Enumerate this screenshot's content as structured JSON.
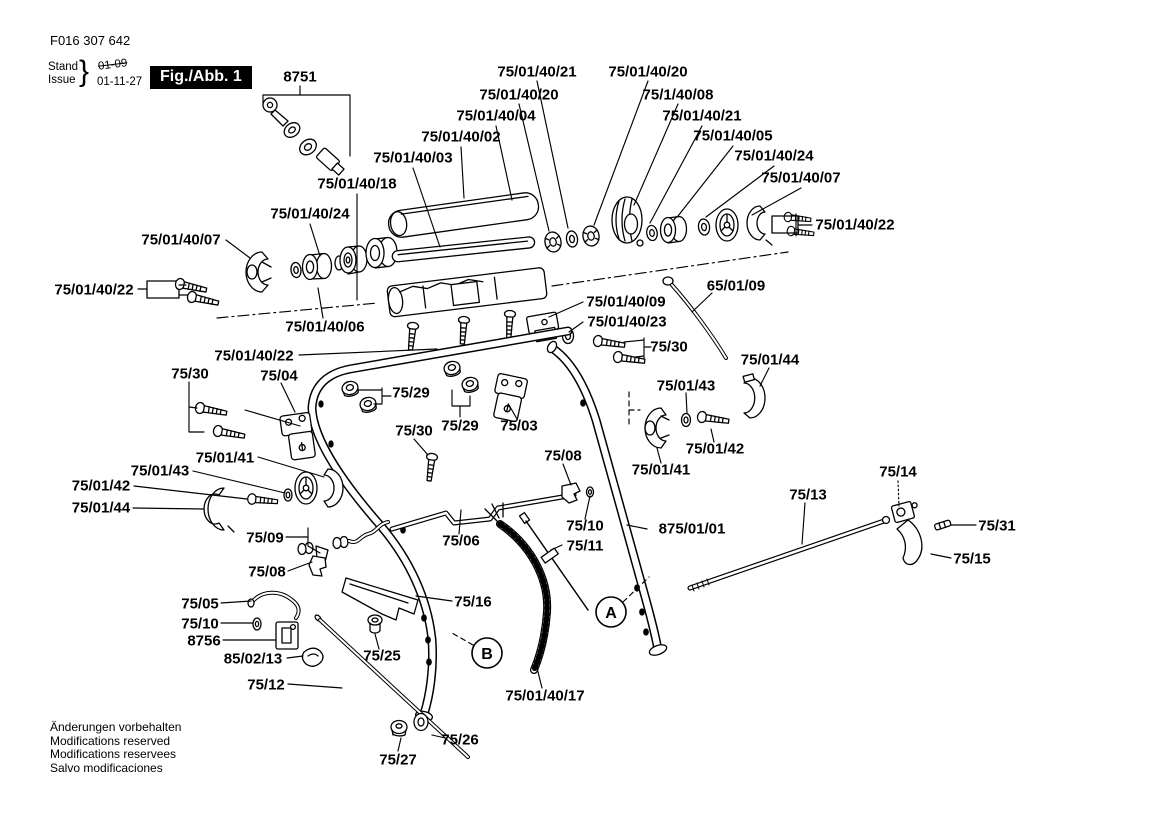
{
  "meta": {
    "part_number": "F016 307 642",
    "stand_label": "Stand",
    "issue_label": "Issue",
    "brace": "}",
    "issue_superseded": "01-09",
    "issue_current": "01-11-27",
    "figure_label": "Fig./Abb. 1"
  },
  "footer": {
    "lines": [
      "Änderungen vorbehalten",
      "Modifications reserved",
      "Modifications reservees",
      "Salvo modificaciones"
    ]
  },
  "colors": {
    "ink": "#000000",
    "paper": "#ffffff",
    "badge_bg": "#000000",
    "badge_fg": "#ffffff"
  },
  "view_markers": [
    {
      "text": "A",
      "x": 611,
      "y": 612
    },
    {
      "text": "B",
      "x": 487,
      "y": 653
    }
  ],
  "labels": [
    {
      "text": "8751",
      "x": 300,
      "y": 77
    },
    {
      "text": "75/01/40/21",
      "x": 537,
      "y": 72
    },
    {
      "text": "75/01/40/20",
      "x": 648,
      "y": 72
    },
    {
      "text": "75/01/40/20",
      "x": 519,
      "y": 95
    },
    {
      "text": "75/1/40/08",
      "x": 678,
      "y": 95
    },
    {
      "text": "75/01/40/04",
      "x": 496,
      "y": 116
    },
    {
      "text": "75/01/40/21",
      "x": 702,
      "y": 116
    },
    {
      "text": "75/01/40/02",
      "x": 461,
      "y": 137
    },
    {
      "text": "75/01/40/05",
      "x": 733,
      "y": 136
    },
    {
      "text": "75/01/40/03",
      "x": 413,
      "y": 158
    },
    {
      "text": "75/01/40/24",
      "x": 774,
      "y": 156
    },
    {
      "text": "75/01/40/18",
      "x": 357,
      "y": 184
    },
    {
      "text": "75/01/40/07",
      "x": 801,
      "y": 178
    },
    {
      "text": "75/01/40/24",
      "x": 310,
      "y": 214
    },
    {
      "text": "75/01/40/07",
      "x": 181,
      "y": 240
    },
    {
      "text": "75/01/40/22",
      "x": 855,
      "y": 225
    },
    {
      "text": "75/01/40/22",
      "x": 94,
      "y": 290
    },
    {
      "text": "75/01/40/06",
      "x": 325,
      "y": 327
    },
    {
      "text": "65/01/09",
      "x": 736,
      "y": 286
    },
    {
      "text": "75/01/40/09",
      "x": 626,
      "y": 302
    },
    {
      "text": "75/01/40/23",
      "x": 627,
      "y": 322
    },
    {
      "text": "75/30",
      "x": 669,
      "y": 347
    },
    {
      "text": "75/01/44",
      "x": 770,
      "y": 360
    },
    {
      "text": "75/01/43",
      "x": 686,
      "y": 386
    },
    {
      "text": "75/01/40/22",
      "x": 254,
      "y": 356
    },
    {
      "text": "75/30",
      "x": 190,
      "y": 374
    },
    {
      "text": "75/04",
      "x": 279,
      "y": 376
    },
    {
      "text": "75/29",
      "x": 411,
      "y": 393
    },
    {
      "text": "75/30",
      "x": 414,
      "y": 431
    },
    {
      "text": "75/29",
      "x": 460,
      "y": 426
    },
    {
      "text": "75/03",
      "x": 519,
      "y": 426
    },
    {
      "text": "75/08",
      "x": 563,
      "y": 456
    },
    {
      "text": "75/01/41",
      "x": 661,
      "y": 470
    },
    {
      "text": "75/01/42",
      "x": 715,
      "y": 449
    },
    {
      "text": "75/01/44",
      "x": 101,
      "y": 508
    },
    {
      "text": "75/01/42",
      "x": 101,
      "y": 486
    },
    {
      "text": "75/01/43",
      "x": 160,
      "y": 471
    },
    {
      "text": "75/01/41",
      "x": 225,
      "y": 458
    },
    {
      "text": "75/09",
      "x": 265,
      "y": 538
    },
    {
      "text": "75/08",
      "x": 267,
      "y": 572
    },
    {
      "text": "75/05",
      "x": 200,
      "y": 604
    },
    {
      "text": "75/10",
      "x": 200,
      "y": 624
    },
    {
      "text": "8756",
      "x": 204,
      "y": 641
    },
    {
      "text": "85/02/13",
      "x": 253,
      "y": 659
    },
    {
      "text": "75/12",
      "x": 266,
      "y": 685
    },
    {
      "text": "75/25",
      "x": 382,
      "y": 656
    },
    {
      "text": "75/16",
      "x": 473,
      "y": 602
    },
    {
      "text": "75/01/40/17",
      "x": 545,
      "y": 696
    },
    {
      "text": "75/26",
      "x": 460,
      "y": 740
    },
    {
      "text": "75/27",
      "x": 398,
      "y": 760
    },
    {
      "text": "75/13",
      "x": 808,
      "y": 495
    },
    {
      "text": "75/14",
      "x": 898,
      "y": 472
    },
    {
      "text": "75/31",
      "x": 997,
      "y": 526
    },
    {
      "text": "75/15",
      "x": 972,
      "y": 559
    },
    {
      "text": "75/10",
      "x": 585,
      "y": 526
    },
    {
      "text": "75/11",
      "x": 585,
      "y": 546
    },
    {
      "text": "875/01/01",
      "x": 692,
      "y": 529
    },
    {
      "text": "75/06",
      "x": 461,
      "y": 541
    }
  ]
}
